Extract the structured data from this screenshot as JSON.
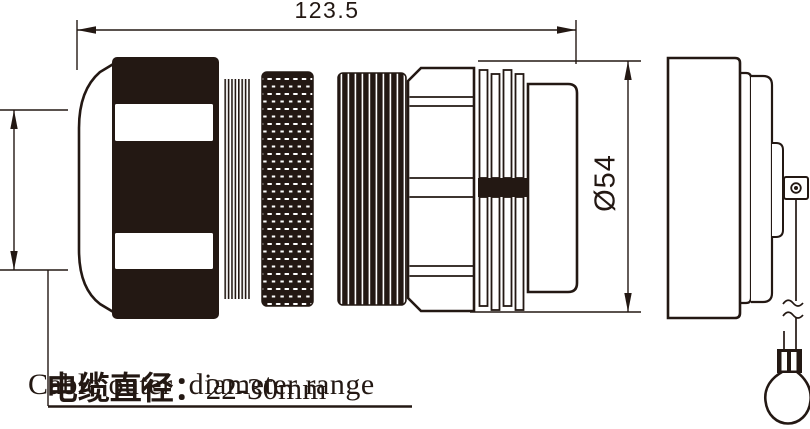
{
  "page": {
    "background": "#ffffff",
    "ink": "#231813"
  },
  "dimensions": {
    "overall_length": "123.5",
    "diameter": "Ø54"
  },
  "cable_note": {
    "cn": "电缆直径：",
    "range": "22-30mm",
    "en": "Cable outer  diameter range"
  }
}
